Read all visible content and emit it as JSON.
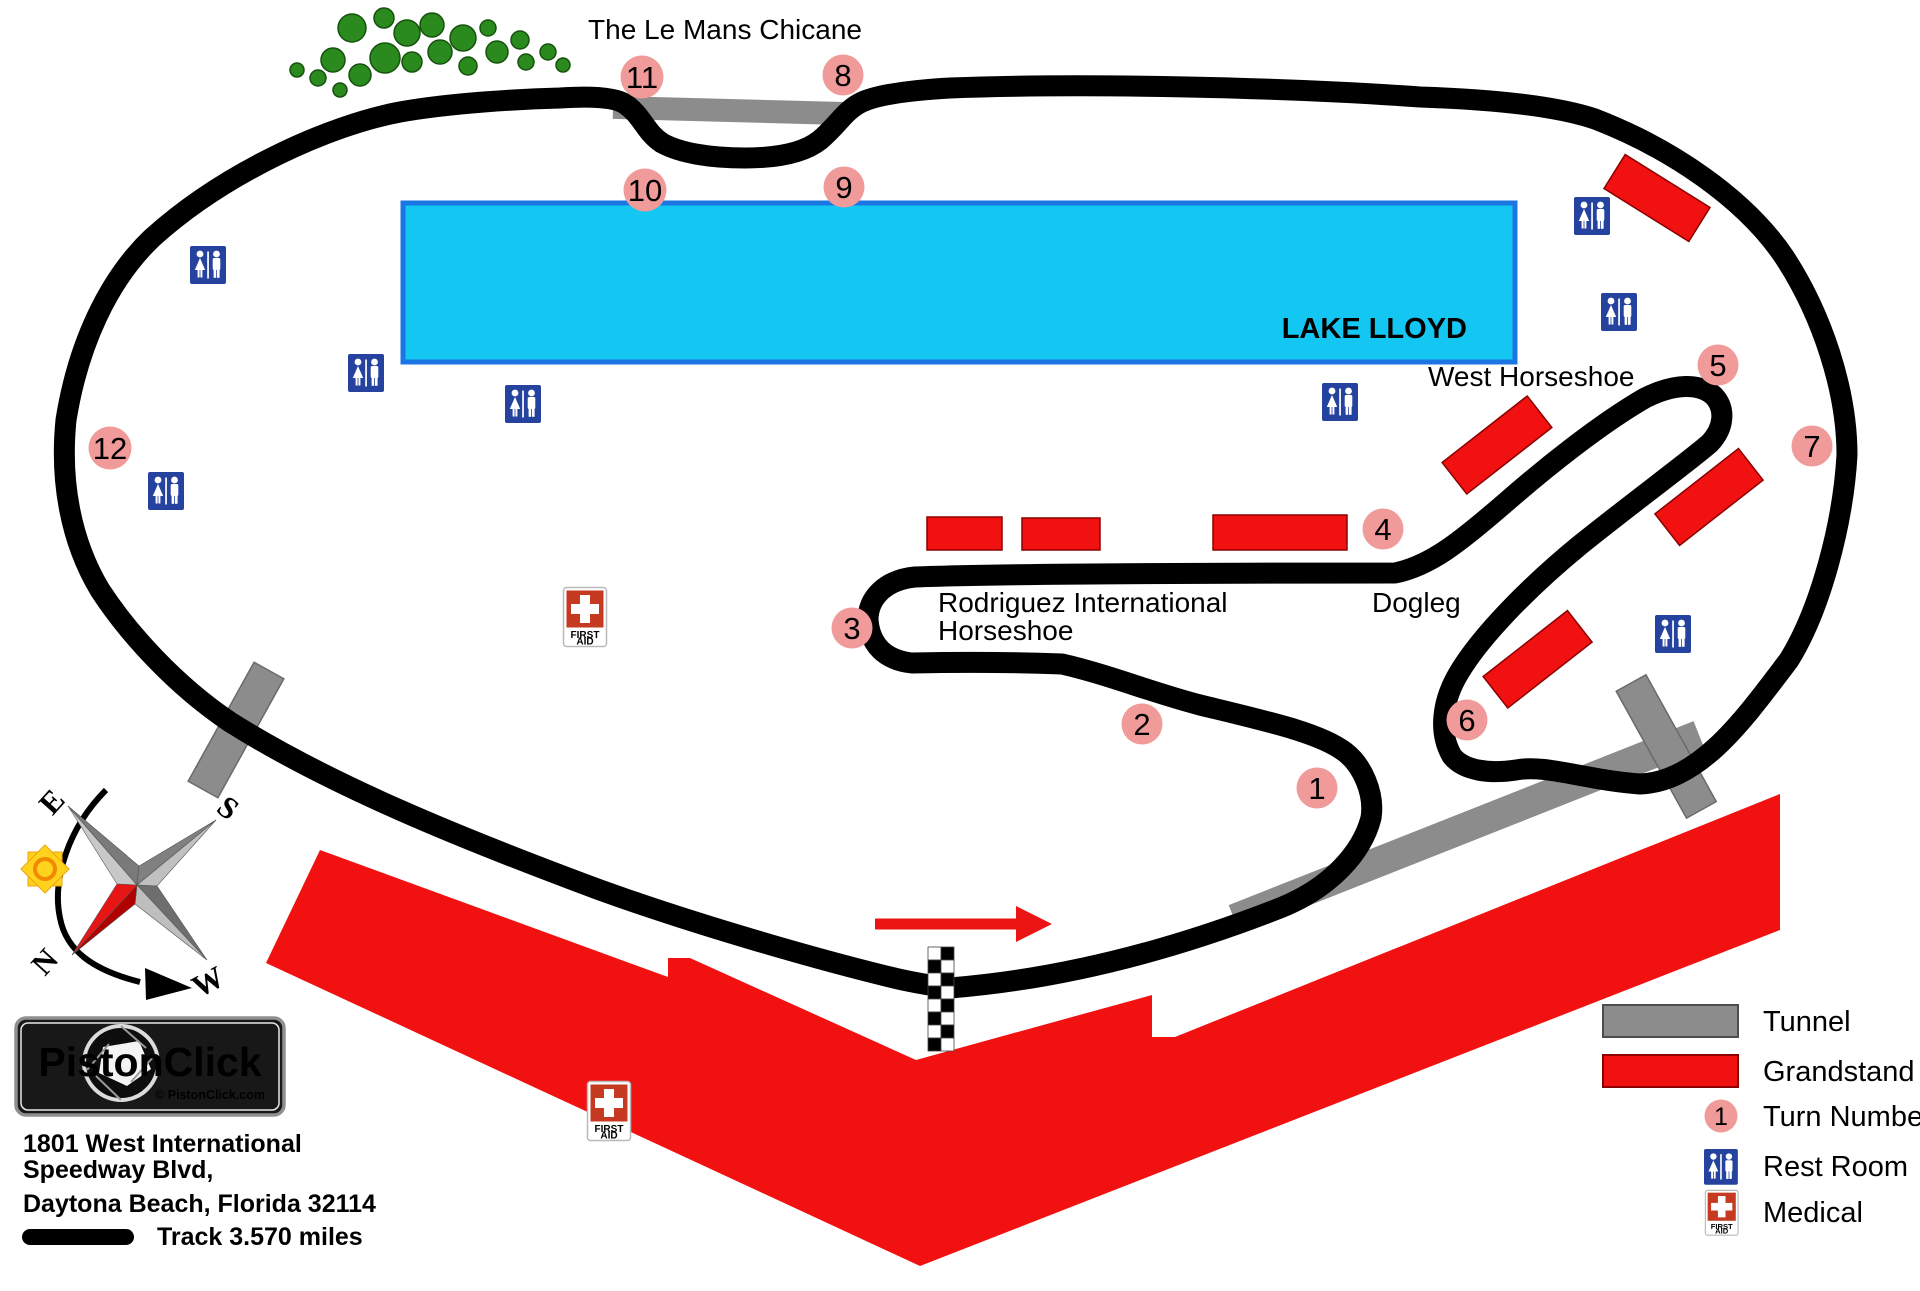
{
  "labels": {
    "title_chicane": "The Le Mans Chicane",
    "lake": "LAKE LLOYD",
    "west_horseshoe": "West Horseshoe",
    "dogleg": "Dogleg",
    "rodriguez_line1": "Rodriguez International",
    "rodriguez_line2": "Horseshoe"
  },
  "turns": [
    "1",
    "2",
    "3",
    "4",
    "5",
    "6",
    "7",
    "8",
    "9",
    "10",
    "11",
    "12"
  ],
  "legend": {
    "tunnel": "Tunnel",
    "grandstand": "Grandstand",
    "turn_number": "Turn Number",
    "turn_sample": "1",
    "rest_room": "Rest Room",
    "medical": "Medical"
  },
  "first_aid_sign": {
    "line1": "FIRST",
    "line2": "AID"
  },
  "compass": {
    "n": "N",
    "e": "E",
    "s": "S",
    "w": "W"
  },
  "logo": {
    "name": "PistonClick",
    "credit": "© PistonClick.com"
  },
  "address": {
    "line1": "1801 West International",
    "line2": "Speedway Blvd,",
    "line3": "Daytona Beach, Florida 32114",
    "track_length": "Track 3.570 miles"
  },
  "colors": {
    "track": "#000000",
    "lake_fill": "#14C6F2",
    "lake_border": "#1B75E3",
    "grandstand": "#F21111",
    "grandstand_border": "#8B0000",
    "tunnel": "#8C8C8C",
    "tunnel_border": "#5E5E5E",
    "turn_marker": "#F09A9A",
    "rest_room_blue": "#24429E",
    "medical_red": "#C63A21",
    "logo_red": "#E01010",
    "tree_green": "#2B8A1D",
    "arrow_red": "#ED1414"
  }
}
